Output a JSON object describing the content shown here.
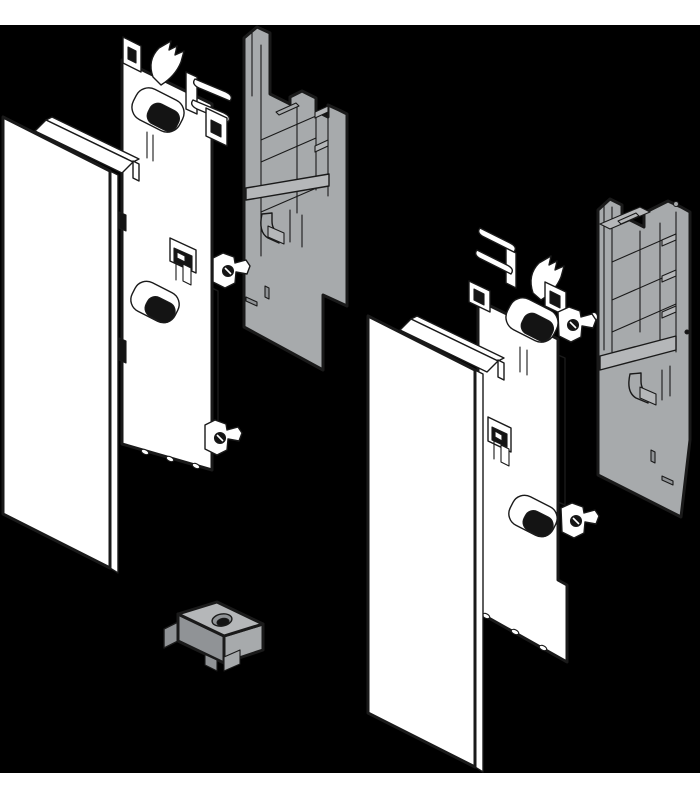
{
  "colors": {
    "page_bg": "#ffffff",
    "canvas_bg": "#000000",
    "ink": "#1a1a1a",
    "part_white": "#ffffff",
    "part_gray": "#a7aaac",
    "part_gray_light": "#b5b7b9",
    "part_gray_dark": "#909396",
    "hole_dark": "#141414"
  },
  "canvas": {
    "width": 700,
    "height": 800,
    "black_band_top": 25,
    "black_band_bottom": 773
  },
  "illustration": {
    "kind": "exploded-assembly-line-drawing",
    "groups": [
      {
        "id": "left-assembly",
        "parts": [
          {
            "name": "front-panel-left",
            "color": "white"
          },
          {
            "name": "mounting-bracket-left",
            "color": "white"
          },
          {
            "name": "adapter-housing-left",
            "color": "gray"
          }
        ]
      },
      {
        "id": "right-assembly",
        "parts": [
          {
            "name": "front-panel-right",
            "color": "white"
          },
          {
            "name": "mounting-bracket-right",
            "color": "white"
          },
          {
            "name": "adapter-housing-right",
            "color": "gray"
          }
        ]
      }
    ],
    "loose_parts": [
      {
        "name": "locking-clip",
        "color": "gray"
      }
    ]
  }
}
